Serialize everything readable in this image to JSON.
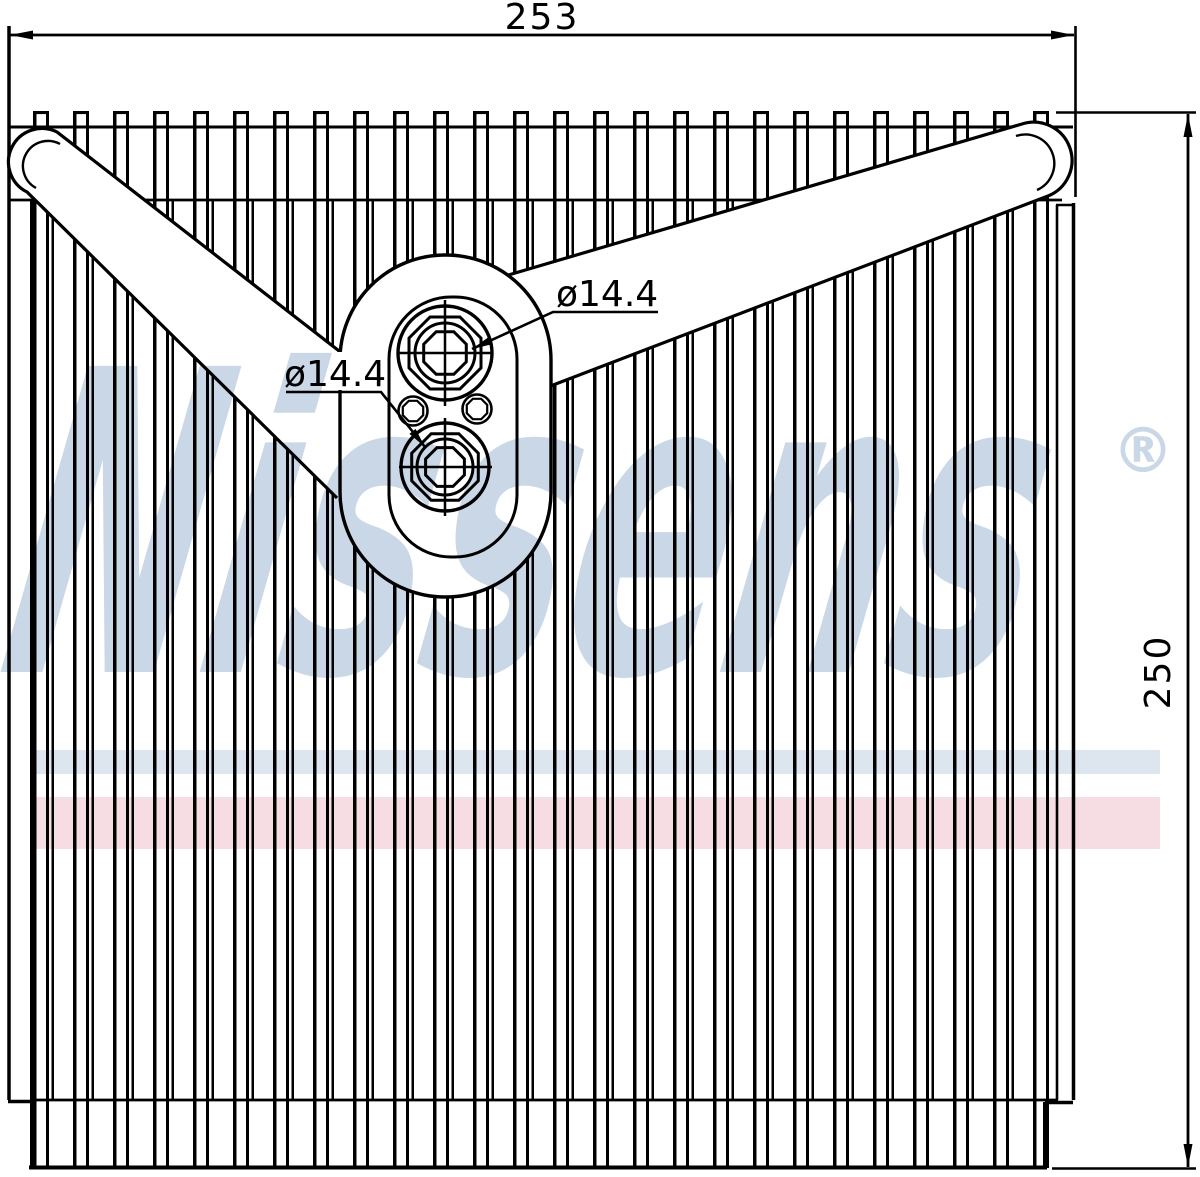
{
  "dimensions": {
    "width_label": "253",
    "height_label": "250"
  },
  "port_labels": {
    "top_port": "ø14.4",
    "bottom_port": "ø14.4"
  },
  "watermark": {
    "brand": "Nissens",
    "registered_mark": "®",
    "color": "#c9d7e7"
  },
  "stripes": {
    "blue_color": "#dde6ef",
    "pink_color": "#f6dde3"
  },
  "line_color": "#000000"
}
